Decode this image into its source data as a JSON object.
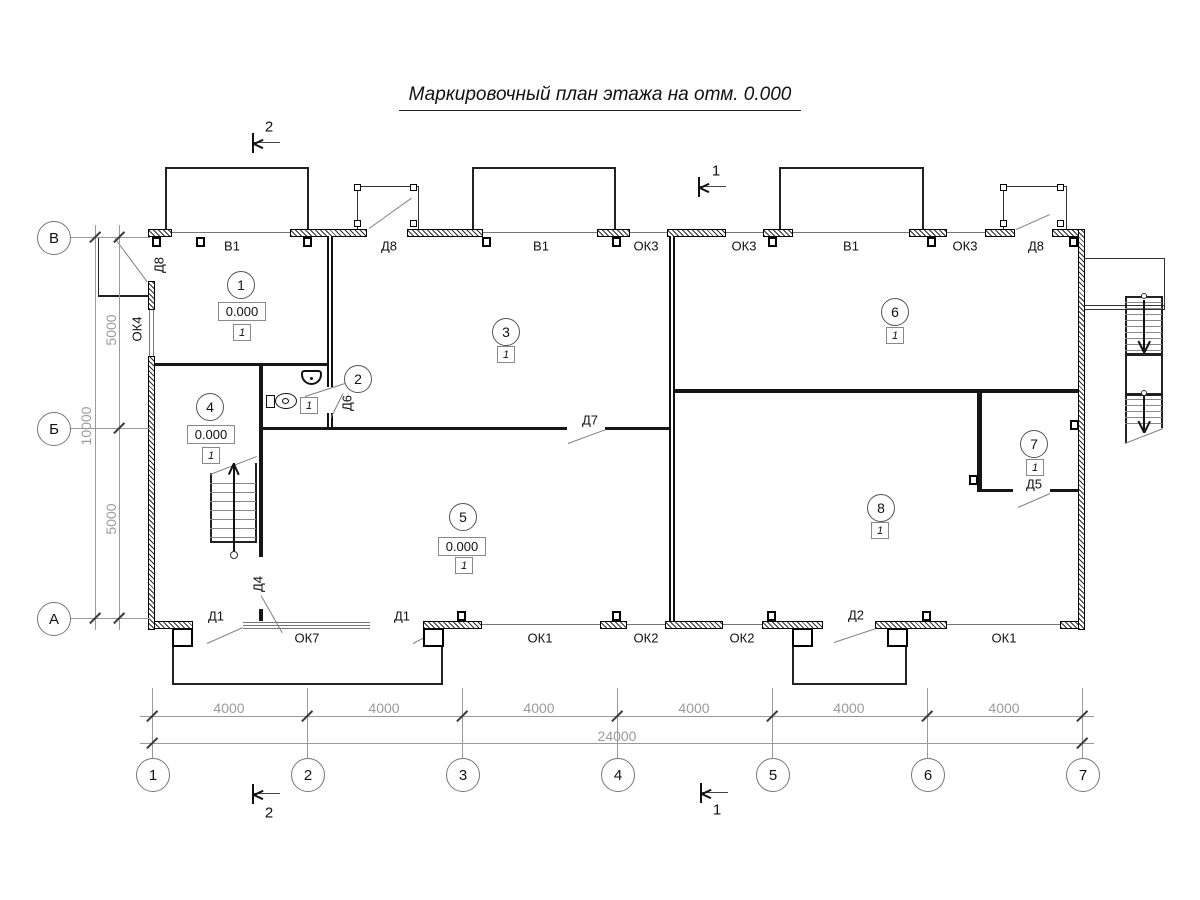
{
  "title": "Маркировочный план этажа на отм. 0.000",
  "axis_grid": {
    "columns": [
      "1",
      "2",
      "3",
      "4",
      "5",
      "6",
      "7"
    ],
    "rows": [
      "В",
      "Б",
      "А"
    ]
  },
  "dimensions": {
    "bay_widths": [
      "4000",
      "4000",
      "4000",
      "4000",
      "4000",
      "4000"
    ],
    "total_width": "24000",
    "row_spans": [
      "5000",
      "10000",
      "5000"
    ]
  },
  "section_marks": {
    "mark_1": "1",
    "mark_2": "2"
  },
  "openings": {
    "top": [
      "В1",
      "Д8",
      "В1",
      "ОК3",
      "ОК3",
      "В1",
      "ОК3",
      "Д8"
    ],
    "bottom": [
      "Д1",
      "ОК7",
      "Д1",
      "ОК1",
      "ОК2",
      "ОК2",
      "Д2",
      "ОК1"
    ],
    "left": [
      "Д8",
      "ОК4"
    ],
    "interior": [
      "Д6",
      "Д4",
      "Д7",
      "Д5"
    ]
  },
  "rooms": [
    {
      "number": "1",
      "elevation": "0.000",
      "finish_type": "1"
    },
    {
      "number": "2",
      "finish_type": "1"
    },
    {
      "number": "3",
      "finish_type": "1"
    },
    {
      "number": "4",
      "elevation": "0.000",
      "finish_type": "1"
    },
    {
      "number": "5",
      "elevation": "0.000",
      "finish_type": "1"
    },
    {
      "number": "6",
      "finish_type": "1"
    },
    {
      "number": "7",
      "finish_type": "1"
    },
    {
      "number": "8",
      "finish_type": "1"
    }
  ]
}
